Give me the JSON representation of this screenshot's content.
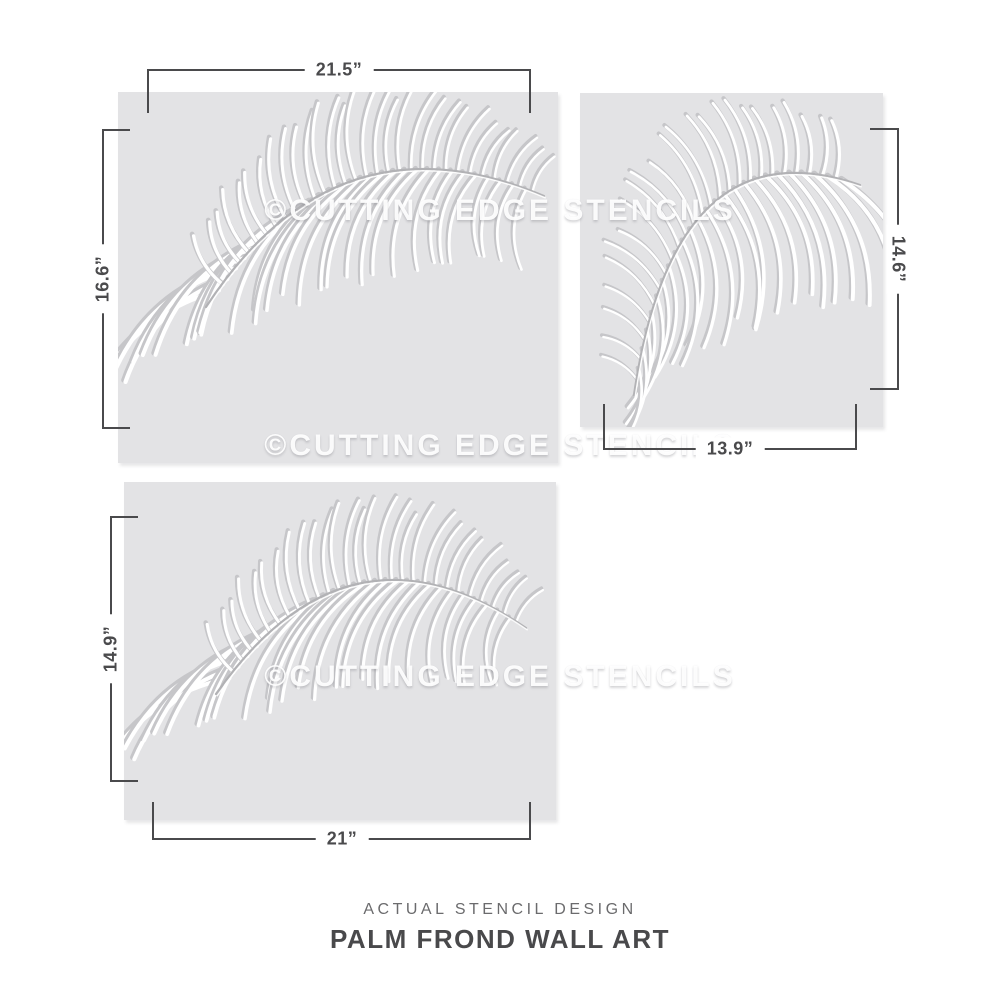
{
  "caption": {
    "subtitle": "ACTUAL STENCIL DESIGN",
    "title": "PALM FROND WALL ART"
  },
  "watermark": {
    "text": "©CUTTING EDGE STENCILS"
  },
  "stencils": [
    {
      "position": "top-left",
      "design": "palm-frond",
      "width_label": "21.5”",
      "height_label": "16.6”"
    },
    {
      "position": "top-right",
      "design": "palm-frond",
      "width_label": "13.9”",
      "height_label": "14.6”"
    },
    {
      "position": "bottom-left",
      "design": "palm-frond",
      "width_label": "21”",
      "height_label": "14.9”"
    }
  ],
  "colors": {
    "page_bg": "#ffffff",
    "panel_bg": "#e3e3e5",
    "stencil_cut": "#ffffff",
    "stencil_shadow": "#c6c6c9",
    "dimension_line": "#4a4a4c",
    "subtitle_text": "#6b6b6d",
    "title_text": "#49494b"
  }
}
